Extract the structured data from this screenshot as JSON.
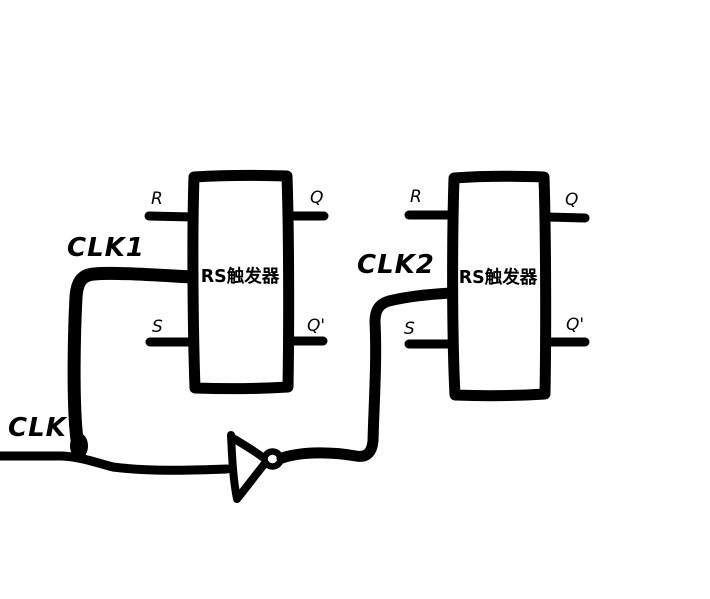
{
  "diagram": {
    "background_color": "#ffffff",
    "ink_color": "#000000",
    "signals": {
      "clk": "CLK",
      "clk1": "CLK1",
      "clk2": "CLK2"
    },
    "flipflop1": {
      "label": "RS触发器",
      "pin_r": "R",
      "pin_s": "S",
      "pin_q": "Q",
      "pin_q_bar": "Q'"
    },
    "flipflop2": {
      "label": "RS触发器",
      "pin_r": "R",
      "pin_s": "S",
      "pin_q": "Q",
      "pin_q_bar": "Q'"
    },
    "inverter_symbol": "not-gate"
  }
}
